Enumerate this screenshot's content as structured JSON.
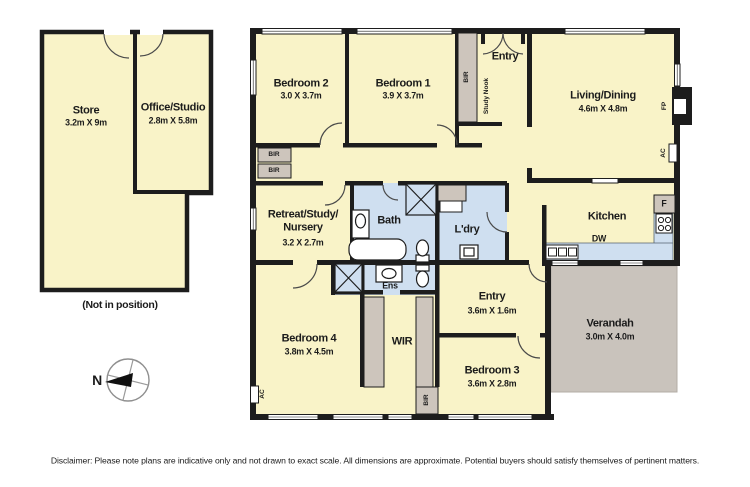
{
  "plan": {
    "outbuilding": {
      "store": {
        "name": "Store",
        "dims": "3.2m X 9m"
      },
      "office": {
        "name": "Office/Studio",
        "dims": "2.8m X 5.8m"
      },
      "note": "(Not in position)"
    },
    "compass": {
      "north_label": "N"
    },
    "rooms": {
      "bedroom2": {
        "name": "Bedroom 2",
        "dims": "3.0 X 3.7m"
      },
      "bedroom1": {
        "name": "Bedroom 1",
        "dims": "3.9 X 3.7m"
      },
      "entry_top": {
        "name": "Entry"
      },
      "living_dining": {
        "name": "Living/Dining",
        "dims": "4.6m X 4.8m"
      },
      "retreat": {
        "name_line1": "Retreat/Study/",
        "name_line2": "Nursery",
        "dims": "3.2 X 2.7m"
      },
      "bath": {
        "name": "Bath"
      },
      "laundry": {
        "name": "L'dry"
      },
      "kitchen": {
        "name": "Kitchen",
        "dishwasher_label": "DW",
        "fridge_label": "F"
      },
      "bedroom4": {
        "name": "Bedroom 4",
        "dims": "3.8m X 4.5m"
      },
      "wir": {
        "name": "WIR"
      },
      "ens": {
        "name": "Ens"
      },
      "entry_lower": {
        "name": "Entry",
        "dims": "3.6m X 1.6m"
      },
      "bedroom3": {
        "name": "Bedroom 3",
        "dims": "3.6m X 2.8m"
      },
      "verandah": {
        "name": "Verandah",
        "dims": "3.0m X 4.0m"
      }
    },
    "fixtures": {
      "bir_label": "BIR",
      "study_nook_label": "Study Nook",
      "fireplace_label": "FP",
      "ac_label": "AC"
    },
    "colors": {
      "room_fill": "#f9f3c8",
      "wet_area_fill": "#cfdff0",
      "robe_fill": "#cdc5bc",
      "verandah_fill": "#c9c3bc",
      "wall": "#1d1d1d"
    },
    "disclaimer": "Disclaimer: Please note plans are indicative only and not drawn to exact scale. All dimensions are approximate. Potential buyers should satisfy themselves of pertinent matters."
  }
}
